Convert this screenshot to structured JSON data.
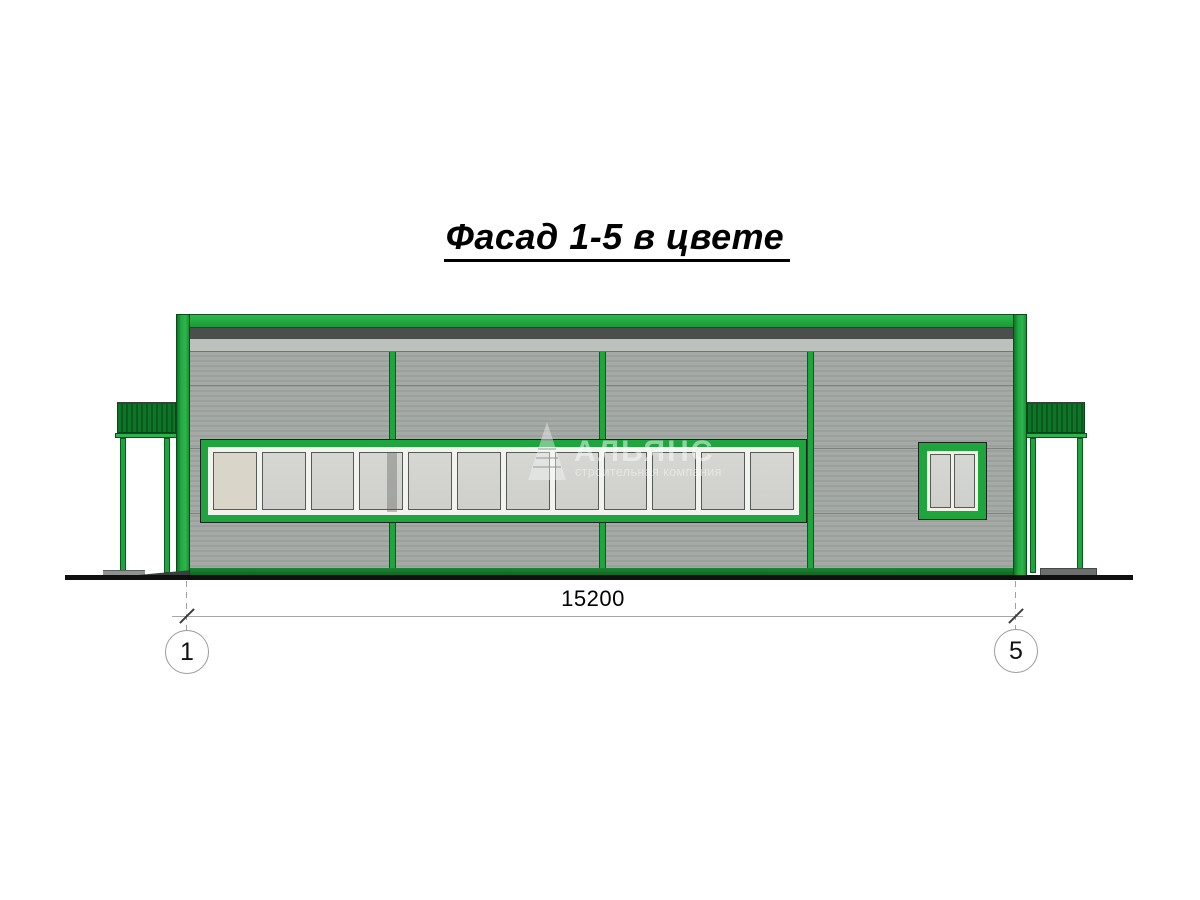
{
  "title": "Фасад 1-5 в цвете",
  "drawing": {
    "dimension_label": "15200",
    "axes": [
      {
        "label": "1"
      },
      {
        "label": "5"
      }
    ]
  },
  "watermark": {
    "company": "АЛЬЯНС",
    "tagline": "строительная компания",
    "logo": "fir-tree-triangle-logo"
  },
  "facade": {
    "ribbon_window_pane_count": 12,
    "small_window_pane_count": 2,
    "mullion_count": 3,
    "canopy_count": 2
  },
  "colors": {
    "accent_green": "#1fa53d",
    "dark_green": "#0d7026",
    "canopy_green": "#0b6322",
    "wall_gray": "#a2a7a4",
    "band_light": "#bdc1be",
    "band_dark": "#4a4e4d",
    "glass_gray": "#d3d4d0",
    "frame_white": "#f2f3ee",
    "ground_black": "#101010",
    "annotation_gray": "#9b9b9b"
  }
}
